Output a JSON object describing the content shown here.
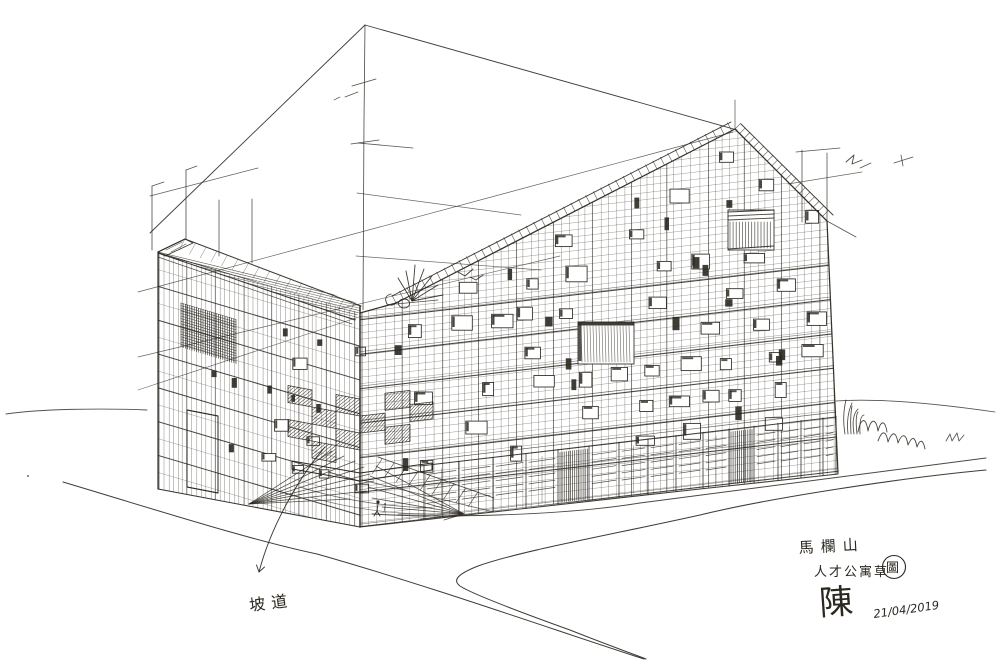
{
  "artwork": {
    "kind": "hand-drawn architectural perspective sketch",
    "medium": "pen and ink on white paper"
  },
  "annotations": {
    "note": "坡道",
    "title_line1": "馬欄山",
    "title_line2_main": "人才公寓草",
    "title_line2_circled": "圖",
    "signature": "陳",
    "date": "21/04/2019"
  },
  "colors": {
    "ink": "#2b2821",
    "paper": "#ffffff"
  }
}
